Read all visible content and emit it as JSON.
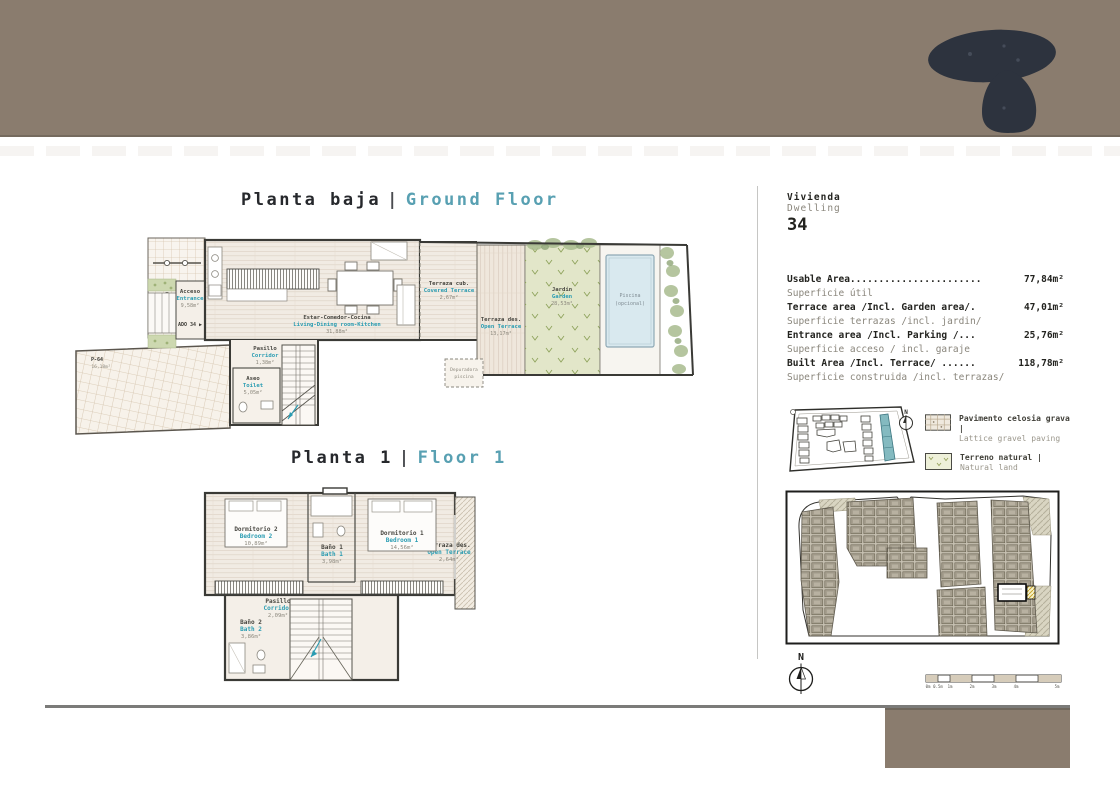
{
  "colors": {
    "banner_taupe": "#8a7c6e",
    "logo_dark": "#2d333e",
    "accent_teal": "#58a0b2",
    "site_highlight_teal": "#84bac0"
  },
  "titles": {
    "ground": {
      "es": "Planta baja",
      "sep": "|",
      "en": "Ground Floor"
    },
    "floor1": {
      "es": "Planta 1",
      "sep": "|",
      "en": "Floor 1"
    }
  },
  "dwelling": {
    "label_es": "Vivienda",
    "label_en": "Dwelling",
    "number": "34"
  },
  "areas": [
    {
      "en": "Usable Area.......................",
      "es": "Superficie útil",
      "value": "77,84m²"
    },
    {
      "en": "Terrace area /Incl. Garden area/.",
      "es": "Superficie terrazas /incl. jardin/",
      "value": "47,01m²"
    },
    {
      "en": "Entrance area /Incl. Parking /...",
      "es": "Superficie acceso / incl. garaje",
      "value": "25,76m²"
    },
    {
      "en": "Built Area /Incl. Terrace/ ......",
      "es": "Superficie construida /incl. terrazas/",
      "value": "118,78m²"
    }
  ],
  "legend": [
    {
      "es": "Pavimento celosia grava |",
      "en": "Lattice gravel paving"
    },
    {
      "es": "Terreno natural |",
      "en": "Natural land"
    }
  ],
  "compass": {
    "label": "N"
  },
  "scalebar": {
    "labels": [
      "0m",
      "0.5m",
      "1m",
      "2m",
      "3m",
      "4m",
      "5m"
    ]
  },
  "ground_rooms": {
    "acceso": {
      "es": "Acceso",
      "en": "Entrance",
      "area": "9,58m²"
    },
    "adq": "ADO 34 ▶",
    "living": {
      "es": "Estar-Comedor-Cocina",
      "en": "Living-Dining room-Kitchen",
      "area": "31,88m²"
    },
    "pasillo": {
      "es": "Pasillo",
      "en": "Corridor",
      "area": "1,38m²"
    },
    "aseo": {
      "es": "Aseo",
      "en": "Toilet",
      "area": "5,05m²"
    },
    "parking": {
      "name": "P-64",
      "area": "16,18m²"
    },
    "terraza_cub": {
      "es": "Terraza cub.",
      "en": "Covered Terrace",
      "area": "2,67m²"
    },
    "terraza_des": {
      "es": "Terraza des.",
      "en": "Open Terrace",
      "area": "13,17m²"
    },
    "jardin": {
      "es": "Jardín",
      "en": "Garden",
      "area": "28,53m²"
    },
    "piscina": {
      "l1": "Piscina",
      "l2": "(opcional)"
    },
    "depuradora": {
      "l1": "Depuradora",
      "l2": "piscina"
    }
  },
  "floor1_rooms": {
    "dorm2": {
      "es": "Dormitorio 2",
      "en": "Bedroom 2",
      "area": "10,89m²"
    },
    "bano1": {
      "es": "Baño 1",
      "en": "Bath 1",
      "area": "3,98m²"
    },
    "dorm1": {
      "es": "Dormitorio 1",
      "en": "Bedroom 1",
      "area": "14,56m²"
    },
    "terraza": {
      "es": "Terraza des.",
      "en": "Open Terrace",
      "area": "2,64m²"
    },
    "pasillo": {
      "es": "Pasillo",
      "en": "Corridor",
      "area": "2,09m²"
    },
    "bano2": {
      "es": "Baño 2",
      "en": "Bath 2",
      "area": "3,86m²"
    }
  }
}
